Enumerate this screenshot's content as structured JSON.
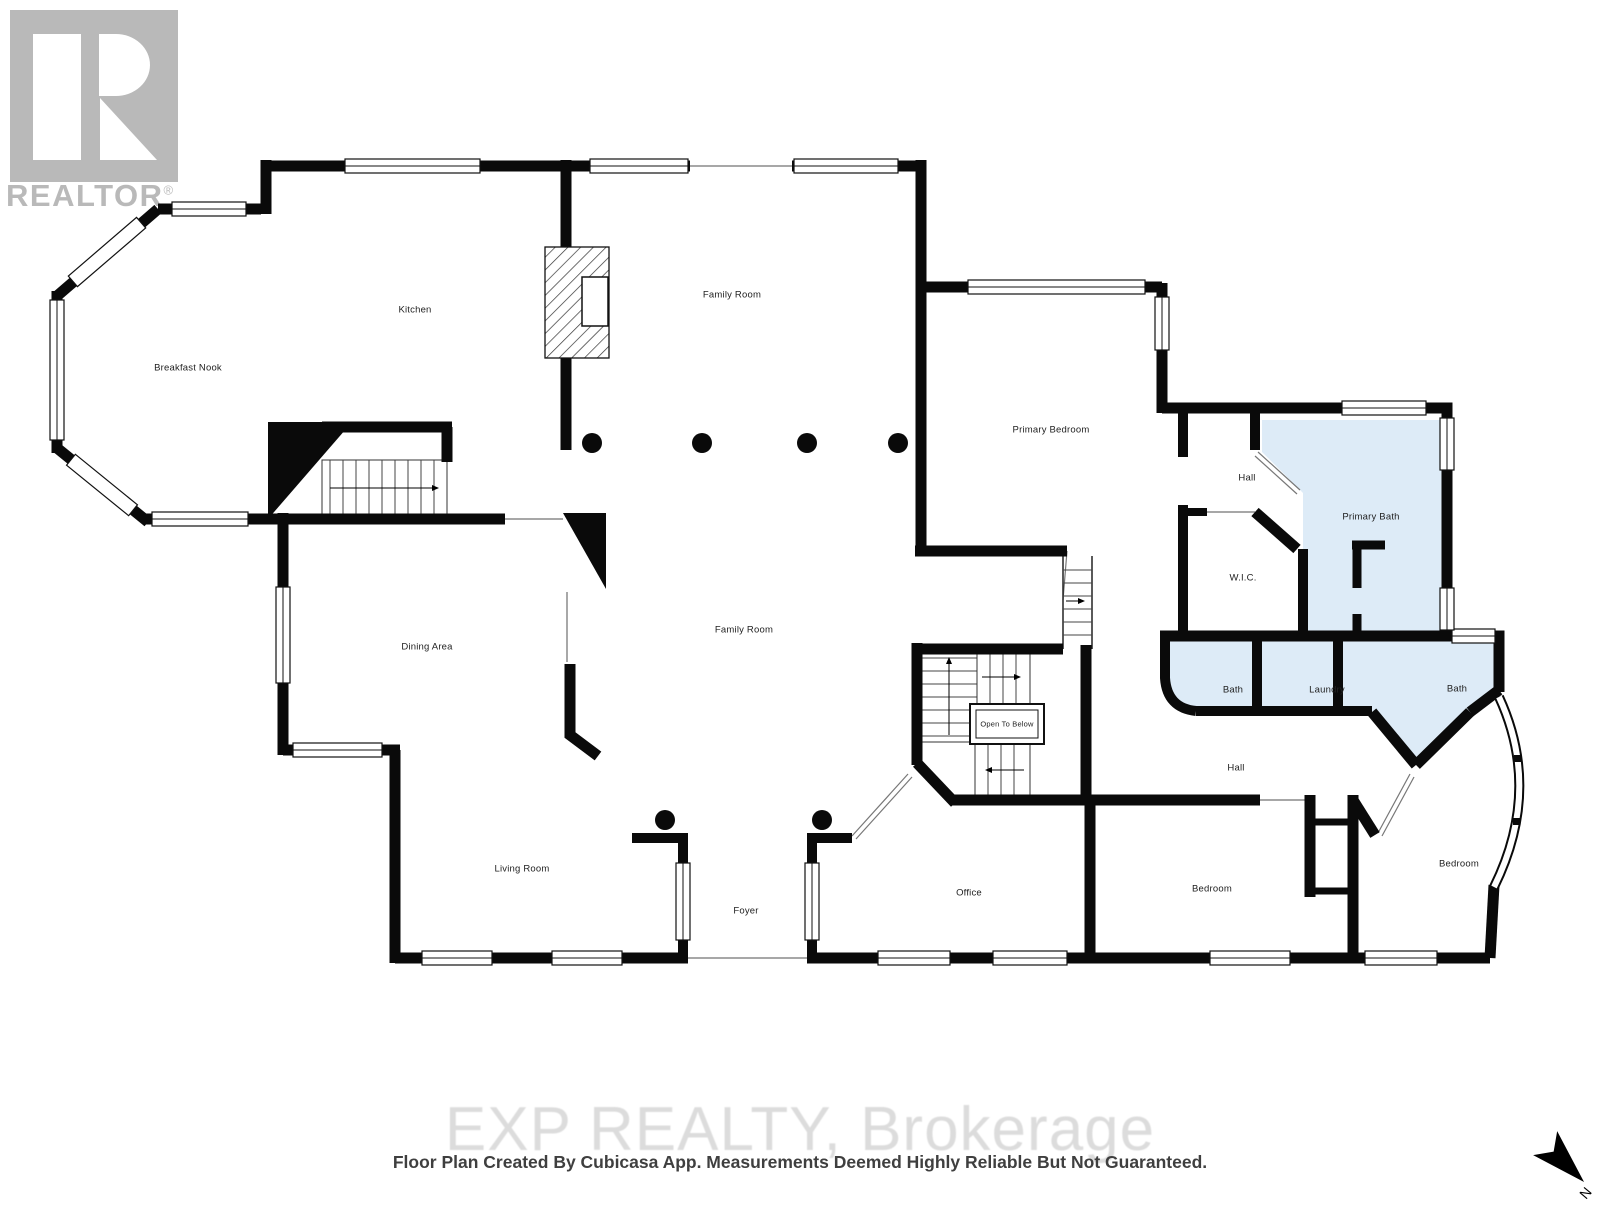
{
  "branding": {
    "logo_letter": "R",
    "realtor_name": "REALTOR",
    "registered_mark": "®"
  },
  "rooms": {
    "kitchen": {
      "label": "Kitchen"
    },
    "breakfast_nook": {
      "label": "Breakfast Nook"
    },
    "family_room_upper": {
      "label": "Family Room"
    },
    "family_room_lower": {
      "label": "Family Room"
    },
    "primary_bedroom": {
      "label": "Primary Bedroom"
    },
    "hall_upper": {
      "label": "Hall"
    },
    "primary_bath": {
      "label": "Primary Bath"
    },
    "wic": {
      "label": "W.I.C."
    },
    "dining_area": {
      "label": "Dining Area"
    },
    "bath_left": {
      "label": "Bath"
    },
    "laundry": {
      "label": "Laundry"
    },
    "bath_right": {
      "label": "Bath"
    },
    "hall_lower": {
      "label": "Hall"
    },
    "open_to_below": {
      "label": "Open To Below"
    },
    "living_room": {
      "label": "Living Room"
    },
    "foyer": {
      "label": "Foyer"
    },
    "office": {
      "label": "Office"
    },
    "bedroom_left": {
      "label": "Bedroom"
    },
    "bedroom_right": {
      "label": "Bedroom"
    }
  },
  "footer": {
    "watermark": "EXP REALTY, Brokerage",
    "disclaimer": "Floor Plan Created By Cubicasa App. Measurements Deemed Highly Reliable But Not Guaranteed."
  },
  "compass": {
    "north_label": "N"
  },
  "colors": {
    "wall": "#0a0a0a",
    "highlight_room_fill": "#ddebf7",
    "watermark_gray": "#b9b9b9",
    "brokerage_watermark": "#dcdcdc",
    "disclaimer_text": "#3f3f3f"
  }
}
